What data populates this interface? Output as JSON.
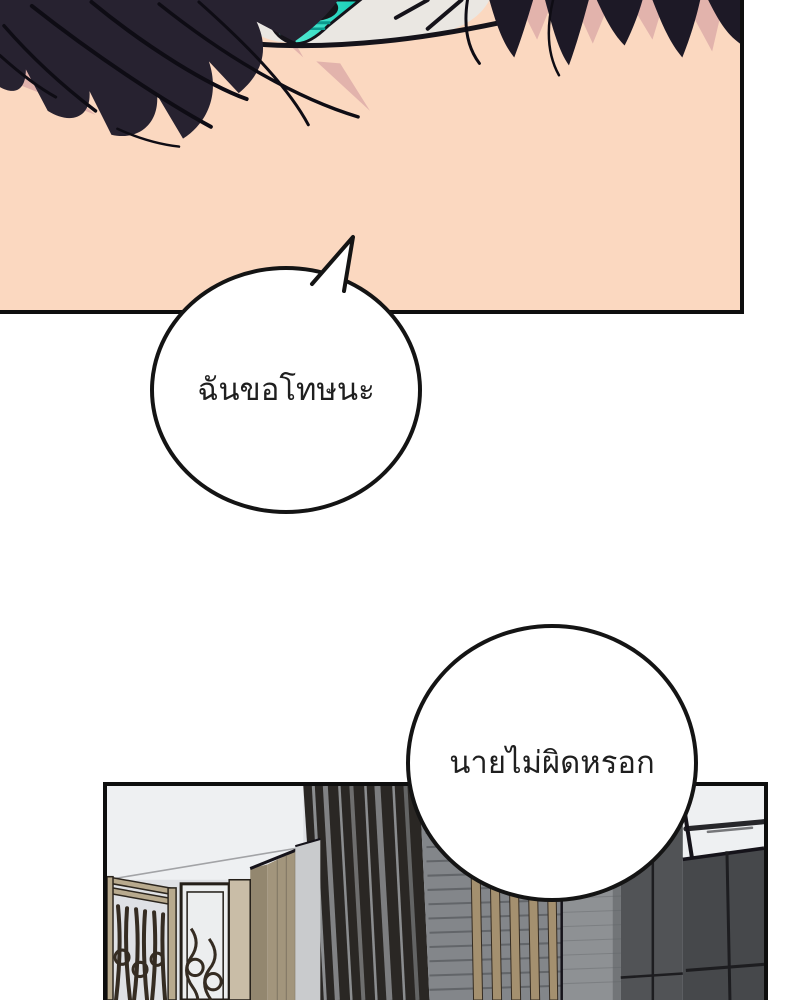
{
  "page": {
    "kind": "webtoon comic page",
    "language": "Thai"
  },
  "bubbles": [
    {
      "text": "ฉันขอโทษนะ"
    },
    {
      "text": "นายไม่ผิดหรอก"
    }
  ],
  "panels": [
    {
      "label": "close-up of a face with a teal eye and dark hair on peach skin"
    },
    {
      "label": "hallway interior with ornate screen, door, cabinets and dark wardrobes"
    }
  ],
  "colors": {
    "page-bg": "#ffffff",
    "panel-border": "#0e0e0e",
    "bubble-bg": "#ffffff",
    "bubble-border": "#141414",
    "text": "#1f1f1f",
    "skin": "#fbd8c0",
    "skin-shadow": "#e2b3ac",
    "hair": "#272230",
    "hair-right": "#1d1926",
    "hair-line": "#0e0c14",
    "line": "#15131a",
    "sclera": "#eae7e2",
    "iris-a": "#6cf4da",
    "iris-b": "#17cdb7",
    "iris-shade": "#0a9a8e",
    "pupil": "#15161a",
    "wall": "#dfe1e5",
    "ceiling": "#eef0f2",
    "wood": "#b8aa8e",
    "wood-dark": "#2c261e",
    "bars": "#352c22",
    "door": "#eceeef",
    "door-frame": "#241f19",
    "jamb": "#c9bda7",
    "cabinet-side": "#93876f",
    "cabinet-front": "#a2957c",
    "cabinet-grain": "#6f6657",
    "gray-column": "#c9cbcd",
    "slats-dark": "#2a2724",
    "slat-gap": "#8b8d8f",
    "stripe-wall": "#83868a",
    "stripe-line": "#5f6266",
    "batten": "#a4906f",
    "texture-column": "#8e9194",
    "texture-line": "#7c7f82",
    "wardrobe-a": "#515356",
    "wardrobe-b": "#46484b",
    "wardrobe-seam": "#1d1d20",
    "streak": "#26262a"
  }
}
